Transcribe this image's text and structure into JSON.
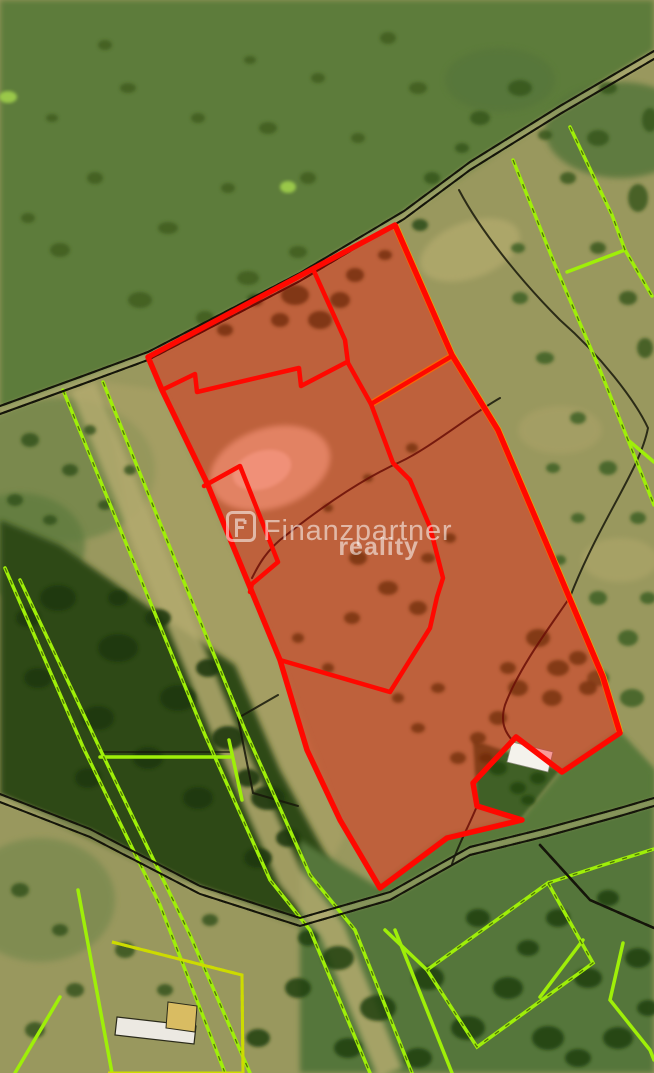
{
  "title": "Aerial cadastral map with highlighted land parcel for sale",
  "watermark": {
    "brand": "Finanzpartner",
    "sub": "reality",
    "logo_letter": "F"
  },
  "colors": {
    "highlight_stroke": "#ff0800",
    "highlight_fill": "rgba(255,0,0,0.36)",
    "cadastral_green": "#9fef08",
    "cadastral_yellow": "#cddb00",
    "boundary_black": "#17170b",
    "underlay_orange": "#ffa200",
    "watermark_white": "rgba(255,255,255,0.55)",
    "grass_green": "#5d7c3a",
    "forest_dark": "#2e4a17",
    "field_olive": "#99985e"
  }
}
